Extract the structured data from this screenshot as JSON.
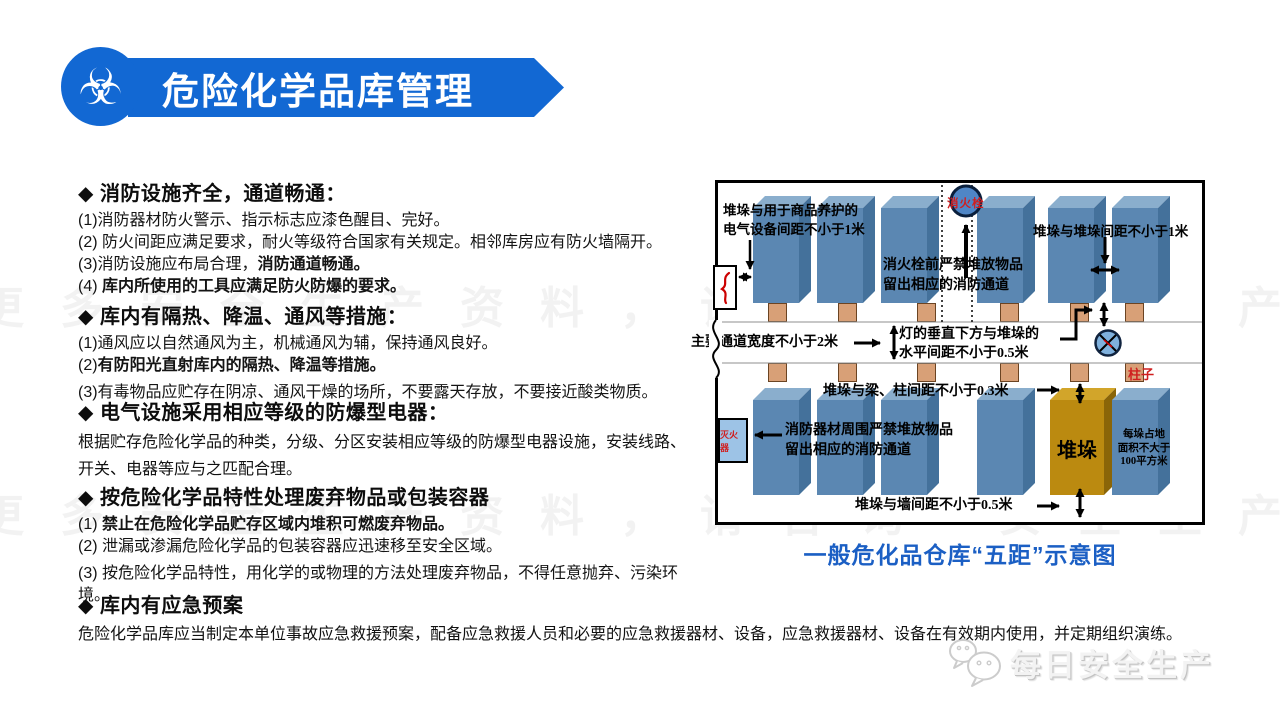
{
  "title": {
    "text": "危险化学品库管理",
    "banner_color": "#1268d3"
  },
  "watermark": "更多安全生产资料，请咨询“安全生产”",
  "sections": [
    {
      "header": "◆ 消防设施齐全，通道畅通：",
      "items": [
        {
          "runs": [
            {
              "t": "(1)消防器材防火警示、指示标志应漆色醒目、完好。",
              "b": false
            }
          ]
        },
        {
          "runs": [
            {
              "t": "(2) 防火间距应满足要求，耐火等级符合国家有关规定。相邻库房应有防火墙隔开。",
              "b": false
            }
          ]
        },
        {
          "runs": [
            {
              "t": "(3)消防设施应布局合理，",
              "b": false
            },
            {
              "t": "消防通道畅通。",
              "b": true
            }
          ]
        },
        {
          "runs": [
            {
              "t": "(4) ",
              "b": false
            },
            {
              "t": "库内所使用的工具应满足防火防爆的要求。",
              "b": true
            }
          ]
        }
      ]
    },
    {
      "header": "◆ 库内有隔热、降温、通风等措施：",
      "items": [
        {
          "runs": [
            {
              "t": "(1)通风应以自然通风为主，机械通风为辅，保持通风良好。",
              "b": false
            }
          ]
        },
        {
          "runs": [
            {
              "t": "(2)",
              "b": false
            },
            {
              "t": "有防阳光直射库内的隔热、降温等措施。",
              "b": true
            }
          ]
        },
        {
          "runs": [
            {
              "t": "(3)有毒物品应贮存在阴凉、通风干燥的场所，不要露天存放，不要接近酸类物质。",
              "b": false
            }
          ]
        }
      ]
    },
    {
      "header": "◆ 电气设施采用相应等级的防爆型电器：",
      "body": [
        "根据贮存危险化学品的种类，分级、分区安装相应等级的防爆型电器设施，安装线路、",
        "开关、电器等应与之匹配合理。"
      ]
    },
    {
      "header": "◆ 按危险化学品特性处理废弃物品或包装容器",
      "items": [
        {
          "runs": [
            {
              "t": "(1) ",
              "b": false
            },
            {
              "t": "禁止在危险化学品贮存区域内堆积可燃废弃物品。",
              "b": true
            }
          ]
        },
        {
          "runs": [
            {
              "t": "(2) 泄漏或渗漏危险化学品的包装容器应迅速移至安全区域。",
              "b": false
            }
          ]
        },
        {
          "runs": [
            {
              "t": "(3) 按危险化学品特性，用化学的或物理的方法处理废弃物品，不得任意抛弃、污染环境。",
              "b": false
            }
          ]
        }
      ]
    },
    {
      "header": "◆ 库内有应急预案",
      "body": [
        "危险化学品库应当制定本单位事故应急救援预案，配备应急救援人员和必要的应急救援器材、设备，应急救援器材、设备在有效期内使用，并定期组织演练。"
      ]
    }
  ],
  "diagram": {
    "caption": "一般危化品仓库“五距”示意图",
    "labels": {
      "stack_care_equipment": [
        "堆垛与用于商品养护的",
        "电气设备间距不小于1米"
      ],
      "hydrant": "消火栓",
      "hydrant_warning": [
        "消火栓前严禁堆放物品",
        "留出相应的消防通道"
      ],
      "stack_to_stack": "堆垛与堆垛间距不小于1米",
      "main_aisle": "主要通道宽度不小于2米",
      "lamp_distance": [
        "灯的垂直下方与堆垛的",
        "水平间距不小于0.5米"
      ],
      "column": "柱子",
      "stack_to_beam": "堆垛与梁、柱间距不小于0.3米",
      "fire_equipment_warning": [
        "消防器材周围严禁堆放物品",
        "留出相应的消防通道"
      ],
      "extinguisher": "灭火器",
      "stack": "堆垛",
      "stack_area": [
        "每垛占地",
        "面积不大于",
        "100平方米"
      ],
      "stack_to_wall": "堆垛与墙间距不小于0.5米"
    },
    "colors": {
      "box_front": "#5b87b2",
      "box_top": "#8aaecd",
      "box_side": "#44719b",
      "gold_front": "#bb8a10",
      "pillar": "#d8a077",
      "extinguisher": "#9dc3e6",
      "caption_blue": "#1b5fc4",
      "annotation_red": "#d01f1f"
    }
  },
  "logo": {
    "text": "每日安全生产"
  }
}
